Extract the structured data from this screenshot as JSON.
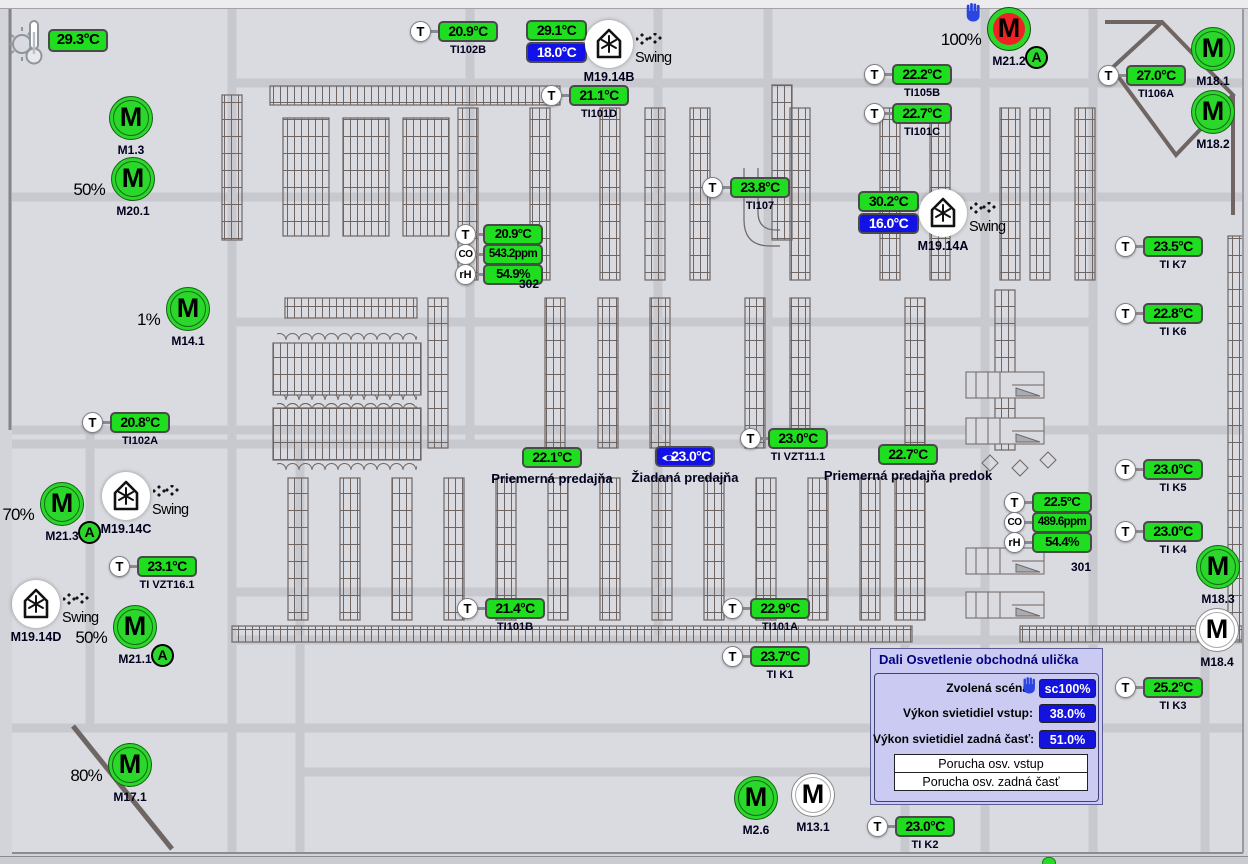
{
  "colors": {
    "ok_green": "#1fdd1f",
    "setpoint_blue": "#1212e8",
    "alarm_red": "#ee2222",
    "hand_blue": "#2b46e0",
    "panel_lavender": "#cacaf2"
  },
  "icons": {
    "t_sensor": "T",
    "co2_sensor": "CO",
    "humidity_sensor": "rH",
    "motor": "M",
    "auto_mode_badge": "A"
  },
  "outdoor": {
    "value": "29.3°C"
  },
  "temperature_sensors": [
    {
      "value": "20.9°C",
      "label": "TI102B",
      "x": 438,
      "y": 21
    },
    {
      "value": "21.1°C",
      "label": "TI101D",
      "x": 569,
      "y": 85
    },
    {
      "value": "22.2°C",
      "label": "TI105B",
      "x": 892,
      "y": 64
    },
    {
      "value": "22.7°C",
      "label": "TI101C",
      "x": 892,
      "y": 103
    },
    {
      "value": "27.0°C",
      "label": "TI106A",
      "x": 1126,
      "y": 65
    },
    {
      "value": "23.8°C",
      "label": "TI107",
      "x": 730,
      "y": 177
    },
    {
      "value": "20.8°C",
      "label": "TI102A",
      "x": 110,
      "y": 412
    },
    {
      "value": "23.1°C",
      "label": "TI VZT16.1",
      "x": 137,
      "y": 556
    },
    {
      "value": "23.0°C",
      "label": "TI VZT11.1",
      "x": 768,
      "y": 428
    },
    {
      "value": "21.4°C",
      "label": "TI101B",
      "x": 485,
      "y": 598
    },
    {
      "value": "22.9°C",
      "label": "TI101A",
      "x": 750,
      "y": 598
    },
    {
      "value": "23.7°C",
      "label": "TI K1",
      "x": 750,
      "y": 646
    },
    {
      "value": "23.0°C",
      "label": "TI K2",
      "x": 895,
      "y": 816
    },
    {
      "value": "25.2°C",
      "label": "TI K3",
      "x": 1143,
      "y": 677
    },
    {
      "value": "23.0°C",
      "label": "TI K4",
      "x": 1143,
      "y": 521
    },
    {
      "value": "23.0°C",
      "label": "TI K5",
      "x": 1143,
      "y": 459
    },
    {
      "value": "22.8°C",
      "label": "TI K6",
      "x": 1143,
      "y": 303
    },
    {
      "value": "23.5°C",
      "label": "TI K7",
      "x": 1143,
      "y": 236
    }
  ],
  "clusters": {
    "302": {
      "id": "302",
      "temperature": "20.9°C",
      "co2": "543.2ppm",
      "humidity": "54.9%"
    },
    "301": {
      "id": "301",
      "temperature": "22.5°C",
      "co2": "489.6ppm",
      "humidity": "54.4%"
    }
  },
  "setpoint_displays": [
    {
      "actual": "29.1°C",
      "setpoint": "18.0°C",
      "x": 526,
      "y": 20
    },
    {
      "actual": "30.2°C",
      "setpoint": "16.0°C",
      "x": 858,
      "y": 191
    }
  ],
  "hvac_units": [
    {
      "label": "M19.14B",
      "swing": "Swing",
      "x": 609,
      "y": 44
    },
    {
      "label": "M19.14A",
      "swing": "Swing",
      "x": 943,
      "y": 213
    },
    {
      "label": "M19.14C",
      "swing": "Swing",
      "x": 126,
      "y": 496
    },
    {
      "label": "M19.14D",
      "swing": "Swing",
      "x": 36,
      "y": 604
    }
  ],
  "motors": [
    {
      "label": "M1.3",
      "cls": "green",
      "percent": "",
      "x": 131,
      "y": 118
    },
    {
      "label": "M20.1",
      "cls": "green",
      "percent": "50%",
      "x": 133,
      "y": 179
    },
    {
      "label": "M14.1",
      "cls": "green",
      "percent": "1%",
      "x": 188,
      "y": 309
    },
    {
      "label": "M21.3",
      "cls": "green auto",
      "percent": "70%",
      "x": 62,
      "y": 504
    },
    {
      "label": "M21.1",
      "cls": "green auto",
      "percent": "50%",
      "x": 135,
      "y": 627
    },
    {
      "label": "M17.1",
      "cls": "green",
      "percent": "80%",
      "x": 130,
      "y": 765
    },
    {
      "label": "M2.6",
      "cls": "green",
      "percent": "",
      "x": 756,
      "y": 798
    },
    {
      "label": "M13.1",
      "cls": "white",
      "percent": "",
      "x": 813,
      "y": 795
    },
    {
      "label": "M18.1",
      "cls": "green",
      "percent": "",
      "x": 1213,
      "y": 49
    },
    {
      "label": "M18.2",
      "cls": "green",
      "percent": "",
      "x": 1213,
      "y": 112
    },
    {
      "label": "M18.3",
      "cls": "green",
      "percent": "",
      "x": 1218,
      "y": 567
    },
    {
      "label": "M18.4",
      "cls": "white",
      "percent": "",
      "x": 1217,
      "y": 630
    },
    {
      "label": "M21.2",
      "cls": "red auto hand",
      "percent": "100%",
      "x": 1009,
      "y": 29
    }
  ],
  "averages": [
    {
      "value": "22.1°C",
      "label": "Priemerná predajňa",
      "cls": "green",
      "x": 522,
      "y": 447
    },
    {
      "value": "23.0°C",
      "label": "Žiadaná predajňa",
      "cls": "blue",
      "x": 655,
      "y": 446
    },
    {
      "value": "22.7°C",
      "label": "Priemerná predajňa predok",
      "cls": "green",
      "x": 878,
      "y": 444
    }
  ],
  "dali_panel": {
    "title": "Dali Osvetlenie obchodná ulička",
    "scene_label": "Zvolená scéna:",
    "scene_value": "sc100%",
    "power_front_label": "Výkon svietidiel vstup:",
    "power_front_value": "38.0%",
    "power_back_label": "Výkon svietidiel zadná časť:",
    "power_back_value": "51.0%",
    "alarm_front": "Porucha osv. vstup",
    "alarm_back": "Porucha osv. zadná časť"
  }
}
